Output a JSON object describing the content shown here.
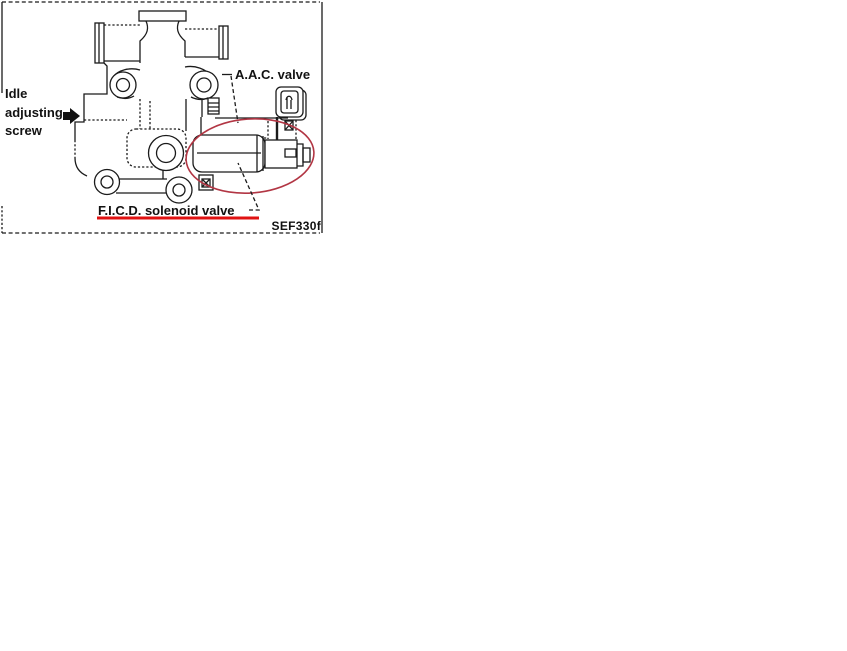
{
  "figure": {
    "code": "SEF330f",
    "labels": {
      "idle_line1": "Idle",
      "idle_line2": "adjusting",
      "idle_line3": "screw",
      "aac": "A.A.C. valve",
      "ficd": "F.I.C.D. solenoid valve"
    },
    "colors": {
      "line": "#1b1b1b",
      "highlight": "#b23644",
      "underline": "#e01212"
    },
    "icons": {
      "idle_pointer_icon": "right-arrow"
    }
  }
}
